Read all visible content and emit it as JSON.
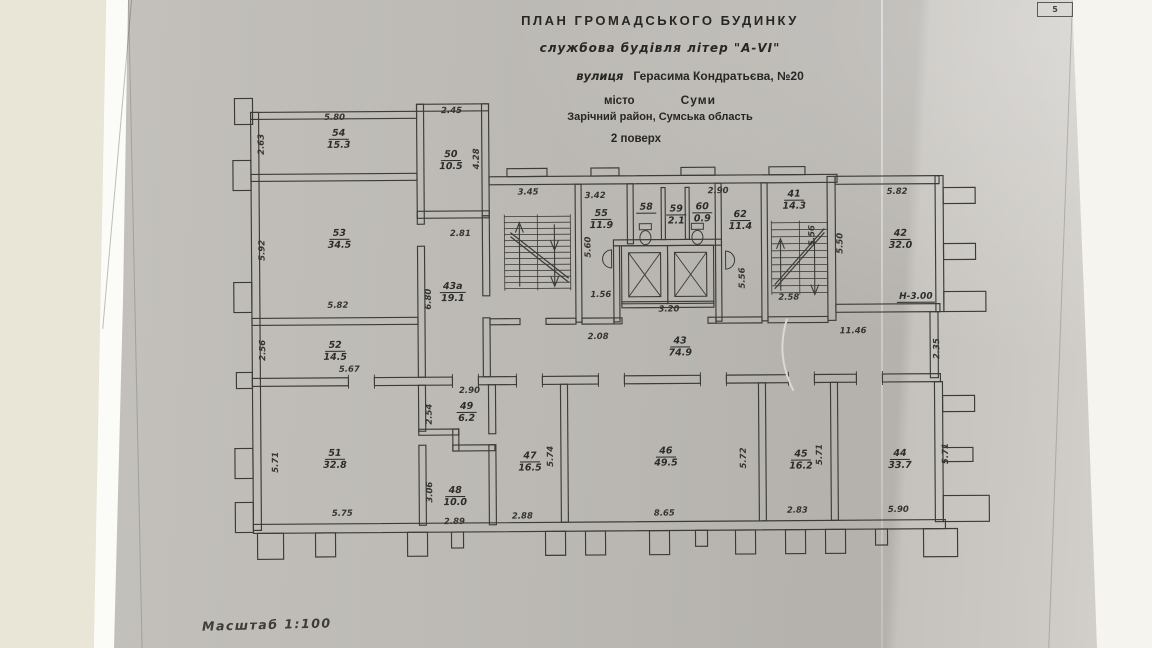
{
  "page": {
    "sheet_number": "5",
    "scale_label": "Масштаб  1:100"
  },
  "title": {
    "line1": "ПЛАН  ГРОМАДСЬКОГО  БУДИНКУ",
    "line2": "службова будівля літер \"А-VI\"",
    "street_prefix": "вулиця",
    "street_name": "Герасима Кондратьєва, №20",
    "city_label": "місто",
    "city_name": "Суми",
    "district": "Зарічний район, Сумська область",
    "floor": "2 поверх"
  },
  "height_mark": "Н-3.00",
  "rooms": [
    {
      "num": "54",
      "area": "15.3"
    },
    {
      "num": "50",
      "area": "10.5"
    },
    {
      "num": "53",
      "area": "34.5"
    },
    {
      "num": "43а",
      "area": "19.1"
    },
    {
      "num": "52",
      "area": "14.5"
    },
    {
      "num": "51",
      "area": "32.8"
    },
    {
      "num": "49",
      "area": "6.2"
    },
    {
      "num": "48",
      "area": "10.0"
    },
    {
      "num": "47",
      "area": "16.5"
    },
    {
      "num": "46",
      "area": "49.5"
    },
    {
      "num": "45",
      "area": "16.2"
    },
    {
      "num": "44",
      "area": "33.7"
    },
    {
      "num": "55",
      "area": "11.9"
    },
    {
      "num": "58",
      "area": ""
    },
    {
      "num": "59",
      "area": "2.1"
    },
    {
      "num": "60",
      "area": "0.9"
    },
    {
      "num": "62",
      "area": "11.4"
    },
    {
      "num": "41",
      "area": "14.3"
    },
    {
      "num": "42",
      "area": "32.0"
    },
    {
      "num": "43",
      "area": "74.9"
    }
  ],
  "dims": [
    "5.80",
    "2.63",
    "2.45",
    "4.28",
    "2.81",
    "5.92",
    "6.80",
    "5.82",
    "2.56",
    "5.67",
    "2.90",
    "2.54",
    "5.71",
    "3.06",
    "5.75",
    "2.89",
    "3.45",
    "3.42",
    "5.60",
    "1.56",
    "2.08",
    "3.20",
    "2.90",
    "5.56",
    "5.56",
    "2.58",
    "5.50",
    "5.82",
    "11.46",
    "2.35",
    "5.74",
    "2.88",
    "8.65",
    "5.72",
    "5.71",
    "2.83",
    "5.90",
    "5.71"
  ],
  "icons": {
    "toilet": "toilet fixture glyph",
    "sink": "semicircular wash-basin glyph",
    "elevator": "crossed-box lift-shaft glyph",
    "stairs": "stepped flights with direction arrows"
  }
}
